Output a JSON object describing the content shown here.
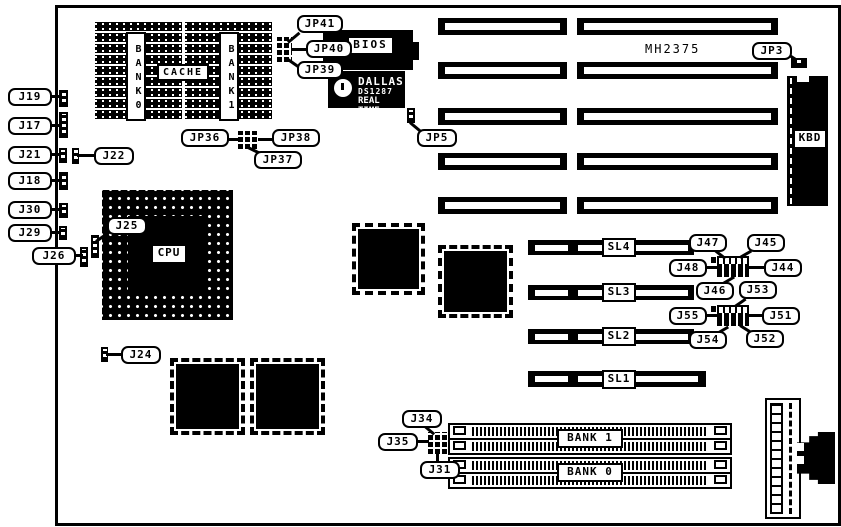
{
  "figure": {
    "board_ref": "MH2375"
  },
  "cache": {
    "title": "CACHE",
    "bank0": "BANK0",
    "bank1": "BANK1"
  },
  "chips": {
    "bios": "BIOS",
    "rtc_line1": "DALLAS",
    "rtc_line2": "DS1287",
    "rtc_line3": "REAL TIME",
    "kbd": "KBD",
    "cpu": "CPU"
  },
  "slots": {
    "sl4": "SL4",
    "sl3": "SL3",
    "sl2": "SL2",
    "sl1": "SL1"
  },
  "memory_banks": {
    "bank1": "BANK 1",
    "bank0": "BANK 0"
  },
  "callouts": {
    "j19": "J19",
    "j17": "J17",
    "j21": "J21",
    "j22": "J22",
    "j18": "J18",
    "j30": "J30",
    "j29": "J29",
    "j26": "J26",
    "j25": "J25",
    "j24": "J24",
    "jp41": "JP41",
    "jp40": "JP40",
    "jp39": "JP39",
    "jp36": "JP36",
    "jp37": "JP37",
    "jp38": "JP38",
    "jp5": "JP5",
    "jp3": "JP3",
    "j47": "J47",
    "j45": "J45",
    "j48": "J48",
    "j44": "J44",
    "j46": "J46",
    "j53": "J53",
    "j55": "J55",
    "j51": "J51",
    "j54": "J54",
    "j52": "J52",
    "j34": "J34",
    "j35": "J35",
    "j31": "J31"
  }
}
